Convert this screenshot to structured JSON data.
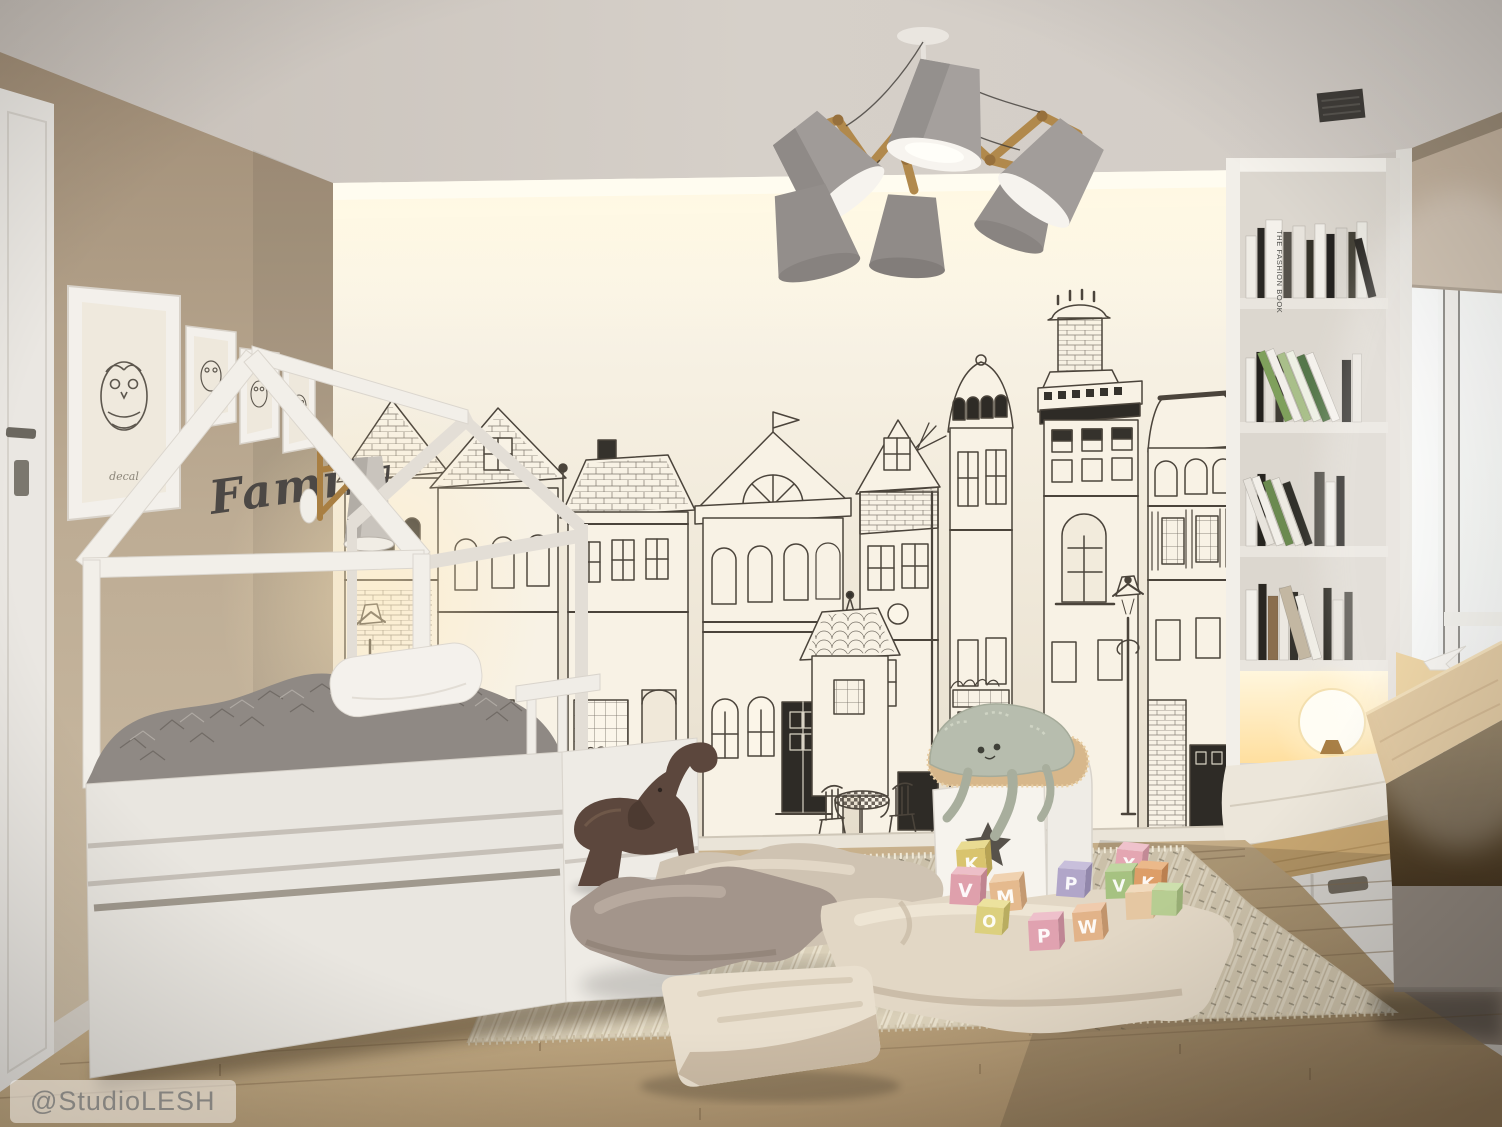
{
  "scene": {
    "type": "interior-render",
    "room": "children's bedroom with house-frame bed and city mural",
    "watermark": "@StudioLESH",
    "family_sign": "Family",
    "frame_caption": "decal",
    "fashion_book_spine": "THE FASHION BOOK"
  },
  "palette": {
    "ceiling": "#d3ccc5",
    "left_wall": "#bcab93",
    "mural_wall": "#f3edе0",
    "mural_line": "#4b443b",
    "cove_glow": "#fff7e0",
    "furniture_white": "#f1eee8",
    "duvet_gray": "#8e8883",
    "wood_accent": "#b18a4c",
    "oak_floor": "#c0a784",
    "rug": "#ddd2bc",
    "cushion_mauve": "#a3958b",
    "cushion_beige": "#e6dbc9",
    "lamp_shade": "#9d9896",
    "warm_glow": "#ffe9b8"
  },
  "chandelier": {
    "shade_count": 6
  },
  "gallery_frames": 4,
  "blocks": [
    {
      "letter": "K",
      "face": "#d9c46e",
      "side": "#b7a354",
      "top": "#e9db92",
      "x": 956,
      "y": 850,
      "s": 29,
      "r": -4
    },
    {
      "letter": "V",
      "face": "#dfa0ac",
      "side": "#c08490",
      "top": "#edbfc8",
      "x": 951,
      "y": 874,
      "s": 30,
      "r": 3
    },
    {
      "letter": "M",
      "face": "#e5ba8e",
      "side": "#c49a72",
      "top": "#f0d2b0",
      "x": 989,
      "y": 883,
      "s": 30,
      "r": -6
    },
    {
      "letter": "O",
      "face": "#dcd07e",
      "side": "#b9ad60",
      "top": "#ece29e",
      "x": 977,
      "y": 906,
      "s": 27,
      "r": 5
    },
    {
      "letter": "P",
      "face": "#e0a2b0",
      "side": "#bf8694",
      "top": "#eec0cb",
      "x": 1028,
      "y": 921,
      "s": 30,
      "r": -3
    },
    {
      "letter": "P",
      "face": "#b1a6c9",
      "side": "#9287ab",
      "top": "#c8bfdb",
      "x": 1058,
      "y": 868,
      "s": 28,
      "r": 4
    },
    {
      "letter": "W",
      "face": "#e2b389",
      "side": "#c1946c",
      "top": "#f0cbad",
      "x": 1072,
      "y": 913,
      "s": 29,
      "r": -5
    },
    {
      "letter": "Y",
      "face": "#e4a6b2",
      "side": "#c28a96",
      "top": "#efc2cc",
      "x": 1117,
      "y": 849,
      "s": 26,
      "r": 6
    },
    {
      "letter": "V",
      "face": "#a6c281",
      "side": "#88a465",
      "top": "#c0d6a1",
      "x": 1105,
      "y": 872,
      "s": 27,
      "r": -2
    },
    {
      "letter": "K",
      "face": "#dd9e68",
      "side": "#bb8050",
      "top": "#ebb98a",
      "x": 1135,
      "y": 868,
      "s": 27,
      "r": 4
    },
    {
      "letter": "",
      "face": "#e5c7a2",
      "side": "#c5a882",
      "top": "#f1dabd",
      "x": 1125,
      "y": 893,
      "s": 27,
      "r": -3
    },
    {
      "letter": "",
      "face": "#b7cd92",
      "side": "#98ae75",
      "top": "#cddfad",
      "x": 1152,
      "y": 890,
      "s": 25,
      "r": 2
    }
  ]
}
